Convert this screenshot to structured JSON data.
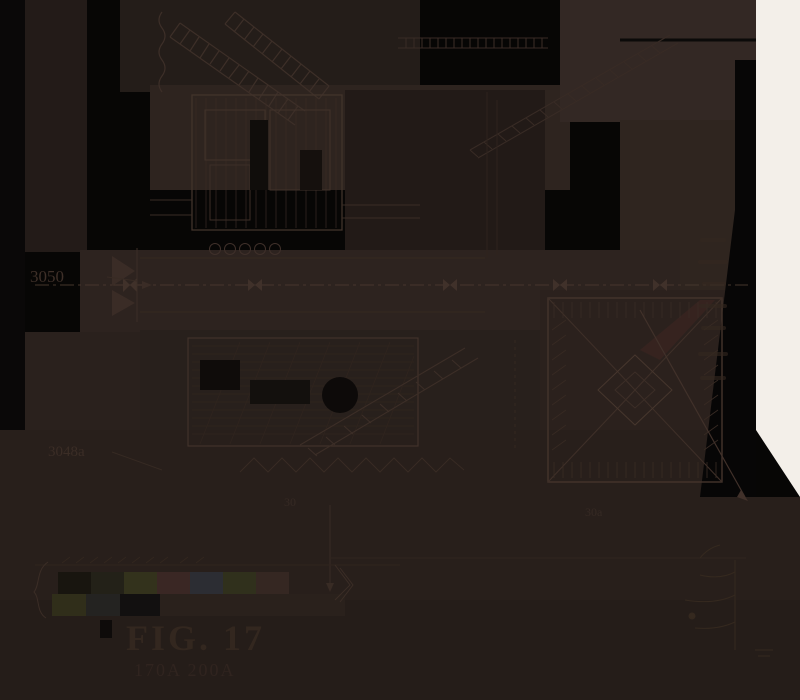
{
  "figure": {
    "caption": "FIG. 17",
    "caption_sub": "170A  200A",
    "labels": {
      "upper_left": "3050",
      "lower_left": "3048a",
      "lower_mid": "30",
      "under_block": "30a"
    }
  },
  "palette": {
    "background": "#070605",
    "patch_brown": "#2b221e",
    "patch_brown_light": "#332824",
    "paper_white": "#f3efe9",
    "line": "#3e3029",
    "line_strong": "#4a3930",
    "line_faint": "#31261f",
    "caption_ink": "#33271f",
    "solid_dark": "#100d0b",
    "maroon_streak": "#3a2421"
  },
  "colorbar": {
    "row1": [
      "#18150f",
      "#232118",
      "#33321c",
      "#3a2724",
      "#2c2d33",
      "#30301c",
      "#352722"
    ],
    "row2": [
      "#302e1a",
      "#242321",
      "#121010",
      "#2a211c"
    ]
  }
}
